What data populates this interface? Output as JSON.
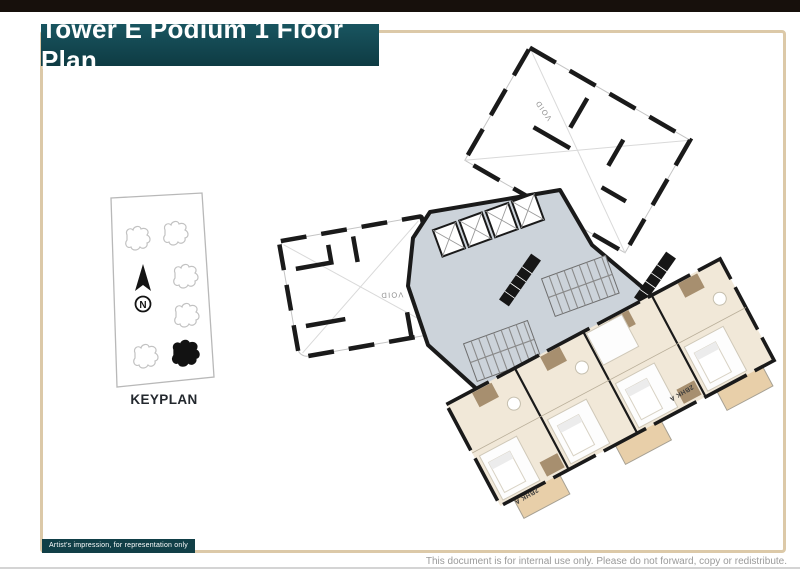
{
  "page": {
    "title": "Tower E Podium 1 Floor Plan",
    "disclaimer_badge": "Artist's impression, for representation only",
    "footer_note": "This document is for internal use only. Please do not forward, copy or redistribute."
  },
  "keyplan": {
    "label": "KEYPLAN",
    "north_label": "N",
    "buildings_total": 6,
    "highlighted_building_index": 5
  },
  "floor_plan": {
    "void_labels": [
      "VOID",
      "VOID"
    ],
    "unit_labels": [
      "2BHK A",
      "2BHK A"
    ],
    "colors": {
      "top_bar": "#17100c",
      "banner_teal": "#0e3b43",
      "frame_tan": "#dcc9a8",
      "core_gray": "#ccd3da",
      "floor_beige": "#f1e8d8",
      "balcony_tan": "#e8cfa9",
      "wet_area_brown": "#a78f6f",
      "wall_black": "#1a1a1a"
    }
  }
}
